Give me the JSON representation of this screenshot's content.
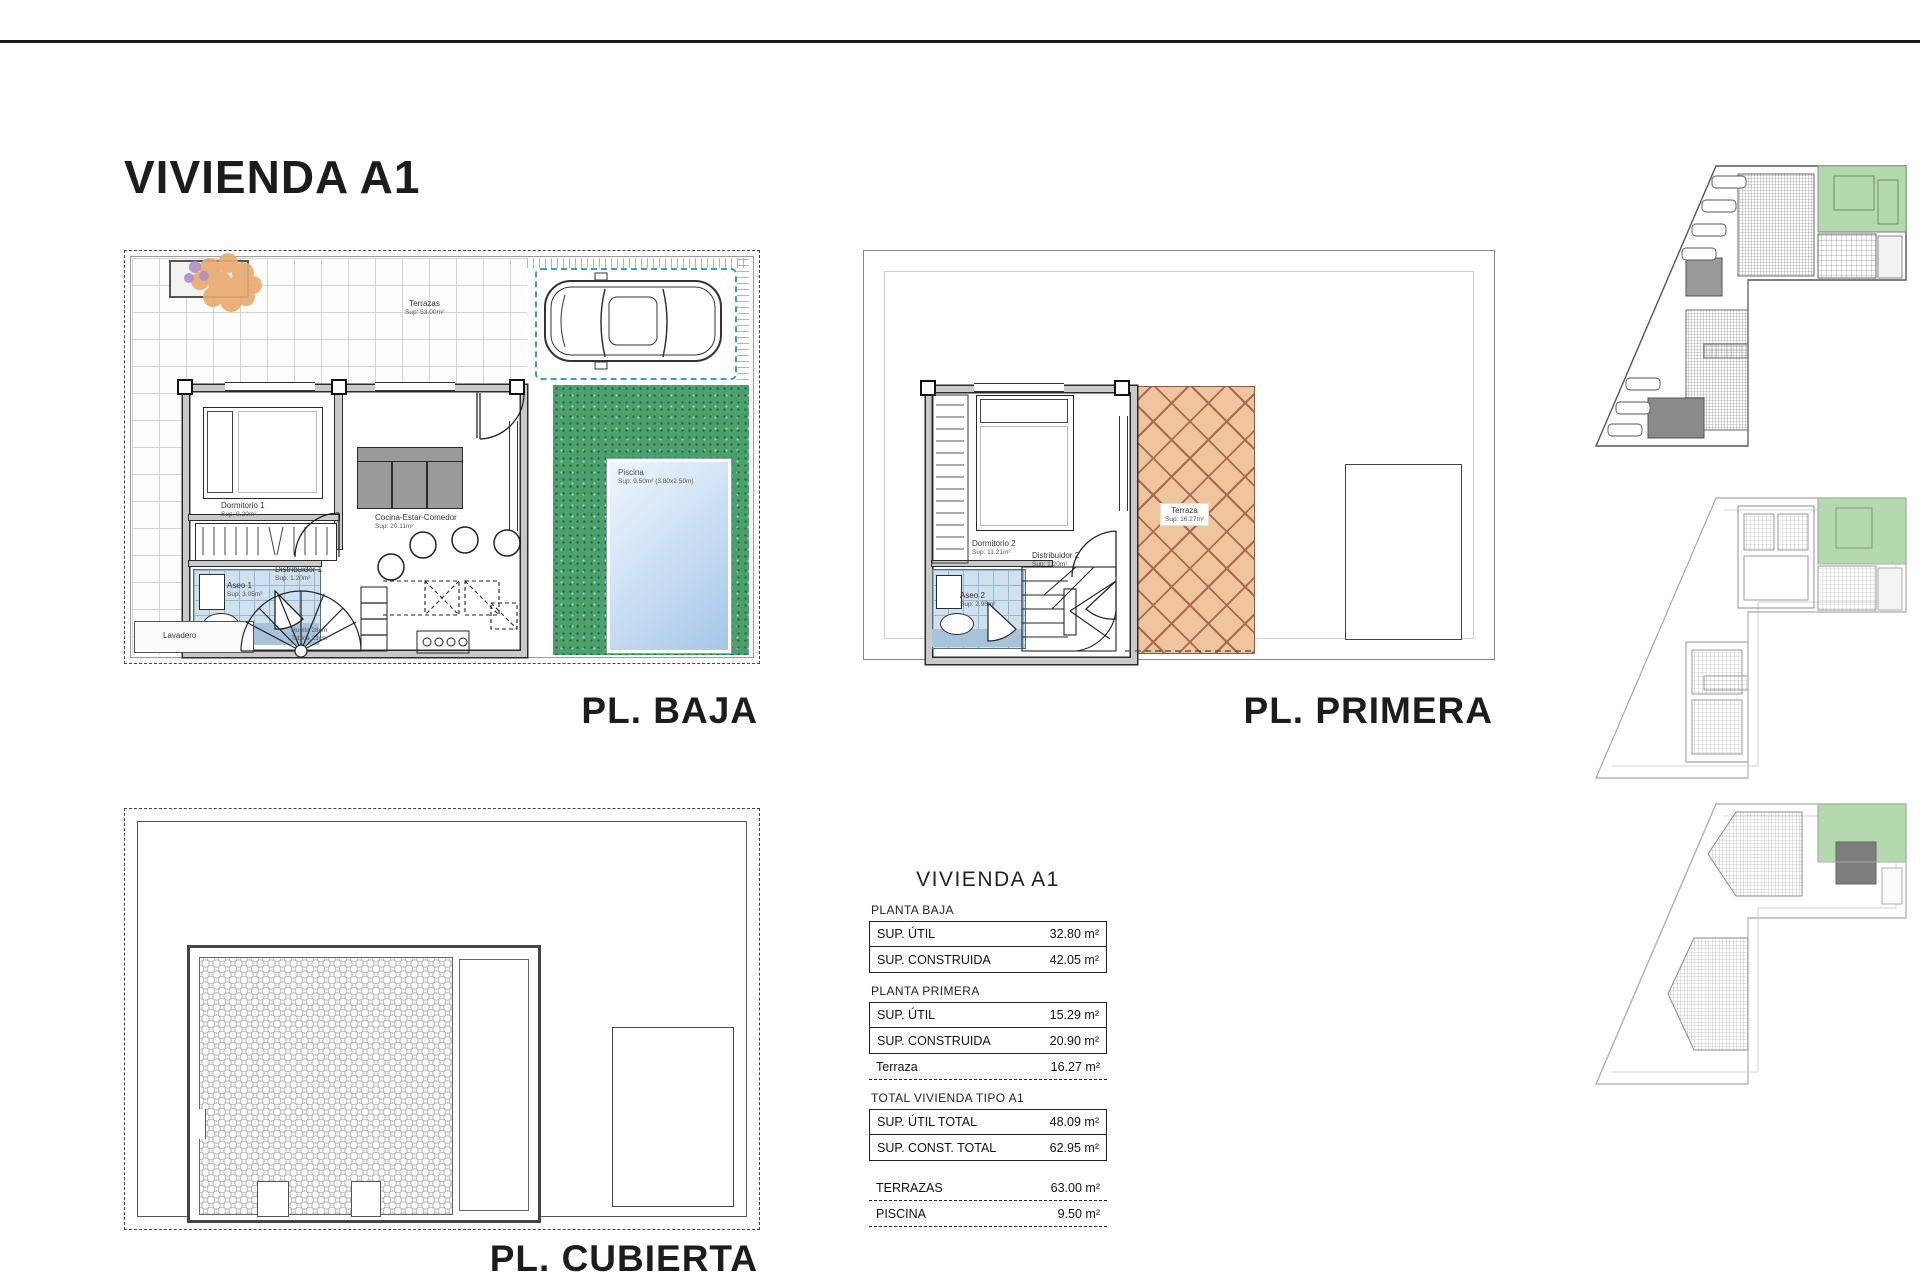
{
  "sheet": {
    "title": "VIVIENDA A1"
  },
  "colors": {
    "grass": "#4ca06c",
    "pool_water": "#cfe2f5",
    "terrace_hatch": "#f0c49c",
    "bath_tiles": "#cfe0ef",
    "keyplan_highlight": "#b5d9ae",
    "line": "#2b2b2b"
  },
  "plans": {
    "baja": {
      "label": "PL. BAJA",
      "rooms": {
        "terraza_name": "Terrazas",
        "terraza_sup": "Sup: 53.00m²",
        "dormitorio_name": "Dormitorio 1",
        "dormitorio_sup": "Sup: 9.20m²",
        "cocina_name": "Cocina-Estar-Comedor",
        "cocina_sup": "Sup: 20.11m²",
        "aseo_name": "Aseo 1",
        "aseo_sup": "Sup: 3.05m²",
        "distribuidor_name": "Distribuidor 1",
        "distribuidor_sup": "Sup: 1.20m²",
        "lavadero_name": "Lavadero",
        "piscina_name": "Piscina",
        "piscina_sup": "Sup: 9.50m² (3.80x2.50m)",
        "stair_note_1": "Huella 28cm",
        "stair_note_2": "Tabica 21cm"
      }
    },
    "primera": {
      "label": "PL. PRIMERA",
      "rooms": {
        "dormitorio_name": "Dormitorio 2",
        "dormitorio_sup": "Sup: 11.21m²",
        "aseo_name": "Aseo 2",
        "aseo_sup": "Sup: 2.95m²",
        "distribuidor_name": "Distribuidor 2",
        "distribuidor_sup": "Sup: 1.20m²",
        "terraza_name": "Terraza",
        "terraza_sup": "Sup: 16.27m²"
      }
    },
    "cubierta": {
      "label": "PL. CUBIERTA"
    }
  },
  "table": {
    "title": "VIVIENDA A1",
    "sections": [
      {
        "heading": "PLANTA BAJA",
        "rows": [
          {
            "label": "SUP. ÚTIL",
            "value": "32.80 m²"
          },
          {
            "label": "SUP. CONSTRUIDA",
            "value": "42.05 m²"
          }
        ]
      },
      {
        "heading": "PLANTA PRIMERA",
        "rows": [
          {
            "label": "SUP. ÚTIL",
            "value": "15.29 m²"
          },
          {
            "label": "SUP. CONSTRUIDA",
            "value": "20.90 m²"
          },
          {
            "label": "Terraza",
            "value": "16.27 m²"
          }
        ]
      },
      {
        "heading": "TOTAL VIVIENDA TIPO A1",
        "rows": [
          {
            "label": "SUP. ÚTIL TOTAL",
            "value": "48.09 m²"
          },
          {
            "label": "SUP. CONST. TOTAL",
            "value": "62.95 m²"
          }
        ]
      },
      {
        "heading": "",
        "rows": [
          {
            "label": "TERRAZAS",
            "value": "63.00 m²"
          },
          {
            "label": "PISCINA",
            "value": "9.50 m²"
          }
        ]
      }
    ]
  }
}
